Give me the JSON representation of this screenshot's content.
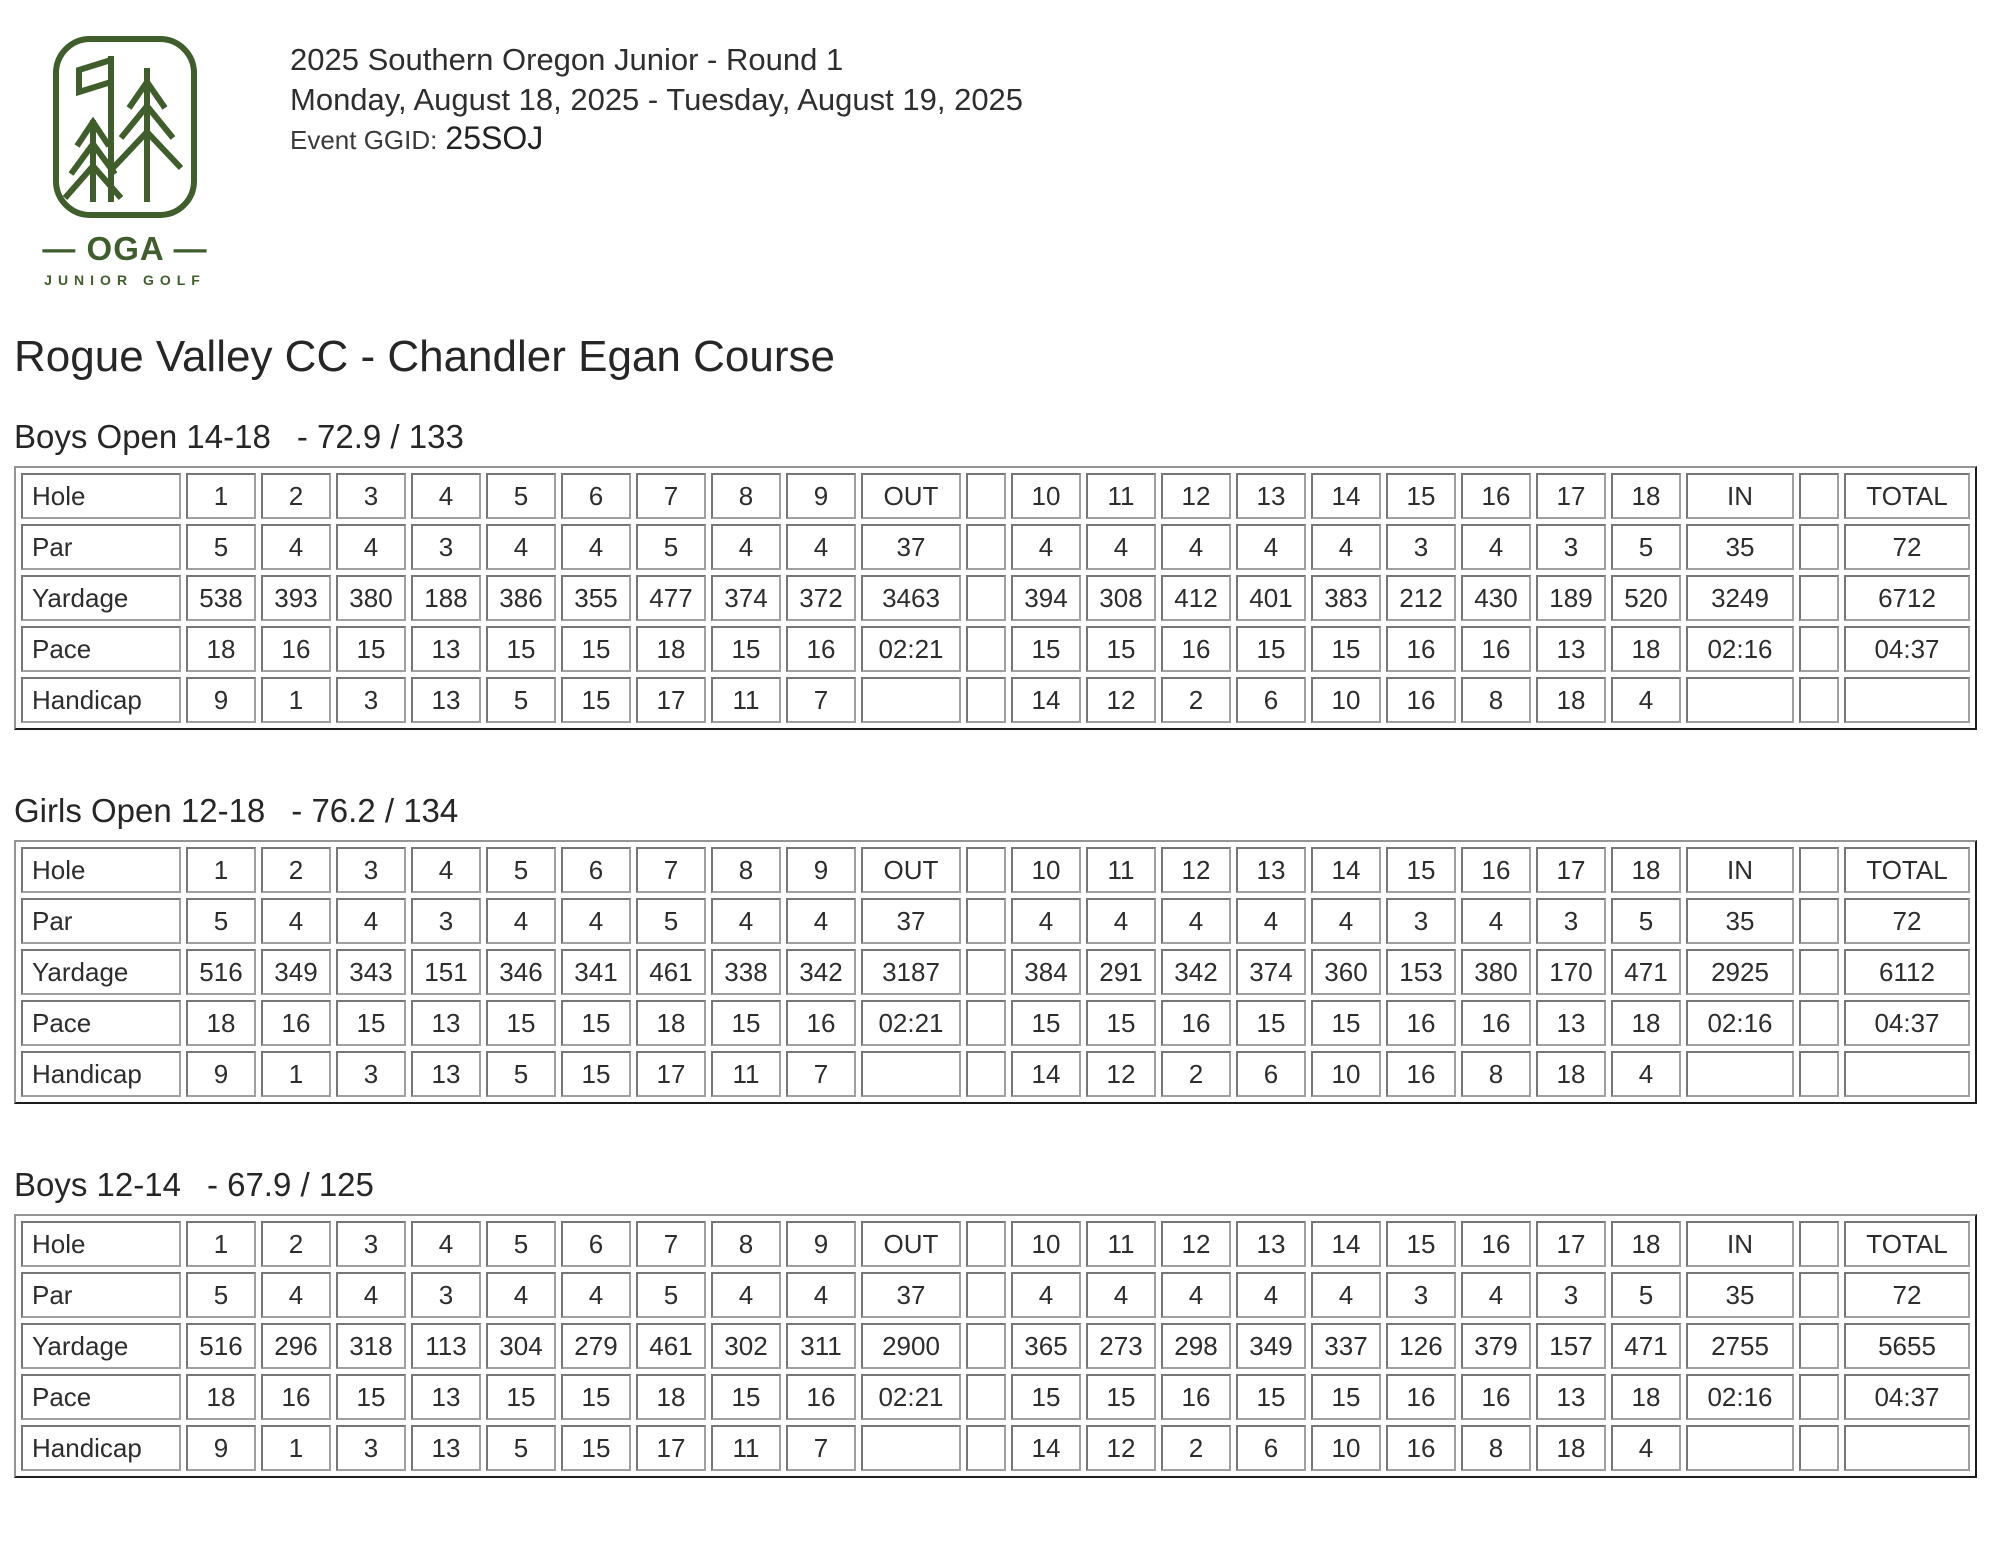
{
  "colors": {
    "logo_green": "#3f5e2b",
    "text_dark": "#2b2b2b",
    "table_border_outer": "#949494",
    "table_border_cell": "#8a8a8a"
  },
  "header": {
    "logo": {
      "icon": "oga-pines-flag-logo",
      "org": "— OGA —",
      "sub": "JUNIOR GOLF"
    },
    "title": "2025 Southern Oregon Junior - Round 1",
    "dates": "Monday, August 18, 2025 - Tuesday, August 19, 2025",
    "ggid_label": "Event GGID:",
    "ggid_value": "25SOJ"
  },
  "course_title": "Rogue Valley CC - Chandler Egan Course",
  "tees": [
    {
      "name": "Boys Open 14-18",
      "rating_slope": "- 72.9 / 133",
      "rows": [
        {
          "label": "Hole",
          "cells": [
            "1",
            "2",
            "3",
            "4",
            "5",
            "6",
            "7",
            "8",
            "9",
            "OUT",
            "",
            "10",
            "11",
            "12",
            "13",
            "14",
            "15",
            "16",
            "17",
            "18",
            "IN",
            "",
            "TOTAL"
          ]
        },
        {
          "label": "Par",
          "cells": [
            "5",
            "4",
            "4",
            "3",
            "4",
            "4",
            "5",
            "4",
            "4",
            "37",
            "",
            "4",
            "4",
            "4",
            "4",
            "4",
            "3",
            "4",
            "3",
            "5",
            "35",
            "",
            "72"
          ]
        },
        {
          "label": "Yardage",
          "cells": [
            "538",
            "393",
            "380",
            "188",
            "386",
            "355",
            "477",
            "374",
            "372",
            "3463",
            "",
            "394",
            "308",
            "412",
            "401",
            "383",
            "212",
            "430",
            "189",
            "520",
            "3249",
            "",
            "6712"
          ]
        },
        {
          "label": "Pace",
          "cells": [
            "18",
            "16",
            "15",
            "13",
            "15",
            "15",
            "18",
            "15",
            "16",
            "02:21",
            "",
            "15",
            "15",
            "16",
            "15",
            "15",
            "16",
            "16",
            "13",
            "18",
            "02:16",
            "",
            "04:37"
          ]
        },
        {
          "label": "Handicap",
          "cells": [
            "9",
            "1",
            "3",
            "13",
            "5",
            "15",
            "17",
            "11",
            "7",
            "",
            "",
            "14",
            "12",
            "2",
            "6",
            "10",
            "16",
            "8",
            "18",
            "4",
            "",
            "",
            ""
          ]
        }
      ]
    },
    {
      "name": "Girls Open 12-18",
      "rating_slope": "- 76.2 / 134",
      "rows": [
        {
          "label": "Hole",
          "cells": [
            "1",
            "2",
            "3",
            "4",
            "5",
            "6",
            "7",
            "8",
            "9",
            "OUT",
            "",
            "10",
            "11",
            "12",
            "13",
            "14",
            "15",
            "16",
            "17",
            "18",
            "IN",
            "",
            "TOTAL"
          ]
        },
        {
          "label": "Par",
          "cells": [
            "5",
            "4",
            "4",
            "3",
            "4",
            "4",
            "5",
            "4",
            "4",
            "37",
            "",
            "4",
            "4",
            "4",
            "4",
            "4",
            "3",
            "4",
            "3",
            "5",
            "35",
            "",
            "72"
          ]
        },
        {
          "label": "Yardage",
          "cells": [
            "516",
            "349",
            "343",
            "151",
            "346",
            "341",
            "461",
            "338",
            "342",
            "3187",
            "",
            "384",
            "291",
            "342",
            "374",
            "360",
            "153",
            "380",
            "170",
            "471",
            "2925",
            "",
            "6112"
          ]
        },
        {
          "label": "Pace",
          "cells": [
            "18",
            "16",
            "15",
            "13",
            "15",
            "15",
            "18",
            "15",
            "16",
            "02:21",
            "",
            "15",
            "15",
            "16",
            "15",
            "15",
            "16",
            "16",
            "13",
            "18",
            "02:16",
            "",
            "04:37"
          ]
        },
        {
          "label": "Handicap",
          "cells": [
            "9",
            "1",
            "3",
            "13",
            "5",
            "15",
            "17",
            "11",
            "7",
            "",
            "",
            "14",
            "12",
            "2",
            "6",
            "10",
            "16",
            "8",
            "18",
            "4",
            "",
            "",
            ""
          ]
        }
      ]
    },
    {
      "name": "Boys 12-14",
      "rating_slope": "- 67.9 / 125",
      "rows": [
        {
          "label": "Hole",
          "cells": [
            "1",
            "2",
            "3",
            "4",
            "5",
            "6",
            "7",
            "8",
            "9",
            "OUT",
            "",
            "10",
            "11",
            "12",
            "13",
            "14",
            "15",
            "16",
            "17",
            "18",
            "IN",
            "",
            "TOTAL"
          ]
        },
        {
          "label": "Par",
          "cells": [
            "5",
            "4",
            "4",
            "3",
            "4",
            "4",
            "5",
            "4",
            "4",
            "37",
            "",
            "4",
            "4",
            "4",
            "4",
            "4",
            "3",
            "4",
            "3",
            "5",
            "35",
            "",
            "72"
          ]
        },
        {
          "label": "Yardage",
          "cells": [
            "516",
            "296",
            "318",
            "113",
            "304",
            "279",
            "461",
            "302",
            "311",
            "2900",
            "",
            "365",
            "273",
            "298",
            "349",
            "337",
            "126",
            "379",
            "157",
            "471",
            "2755",
            "",
            "5655"
          ]
        },
        {
          "label": "Pace",
          "cells": [
            "18",
            "16",
            "15",
            "13",
            "15",
            "15",
            "18",
            "15",
            "16",
            "02:21",
            "",
            "15",
            "15",
            "16",
            "15",
            "15",
            "16",
            "16",
            "13",
            "18",
            "02:16",
            "",
            "04:37"
          ]
        },
        {
          "label": "Handicap",
          "cells": [
            "9",
            "1",
            "3",
            "13",
            "5",
            "15",
            "17",
            "11",
            "7",
            "",
            "",
            "14",
            "12",
            "2",
            "6",
            "10",
            "16",
            "8",
            "18",
            "4",
            "",
            "",
            ""
          ]
        }
      ]
    }
  ]
}
